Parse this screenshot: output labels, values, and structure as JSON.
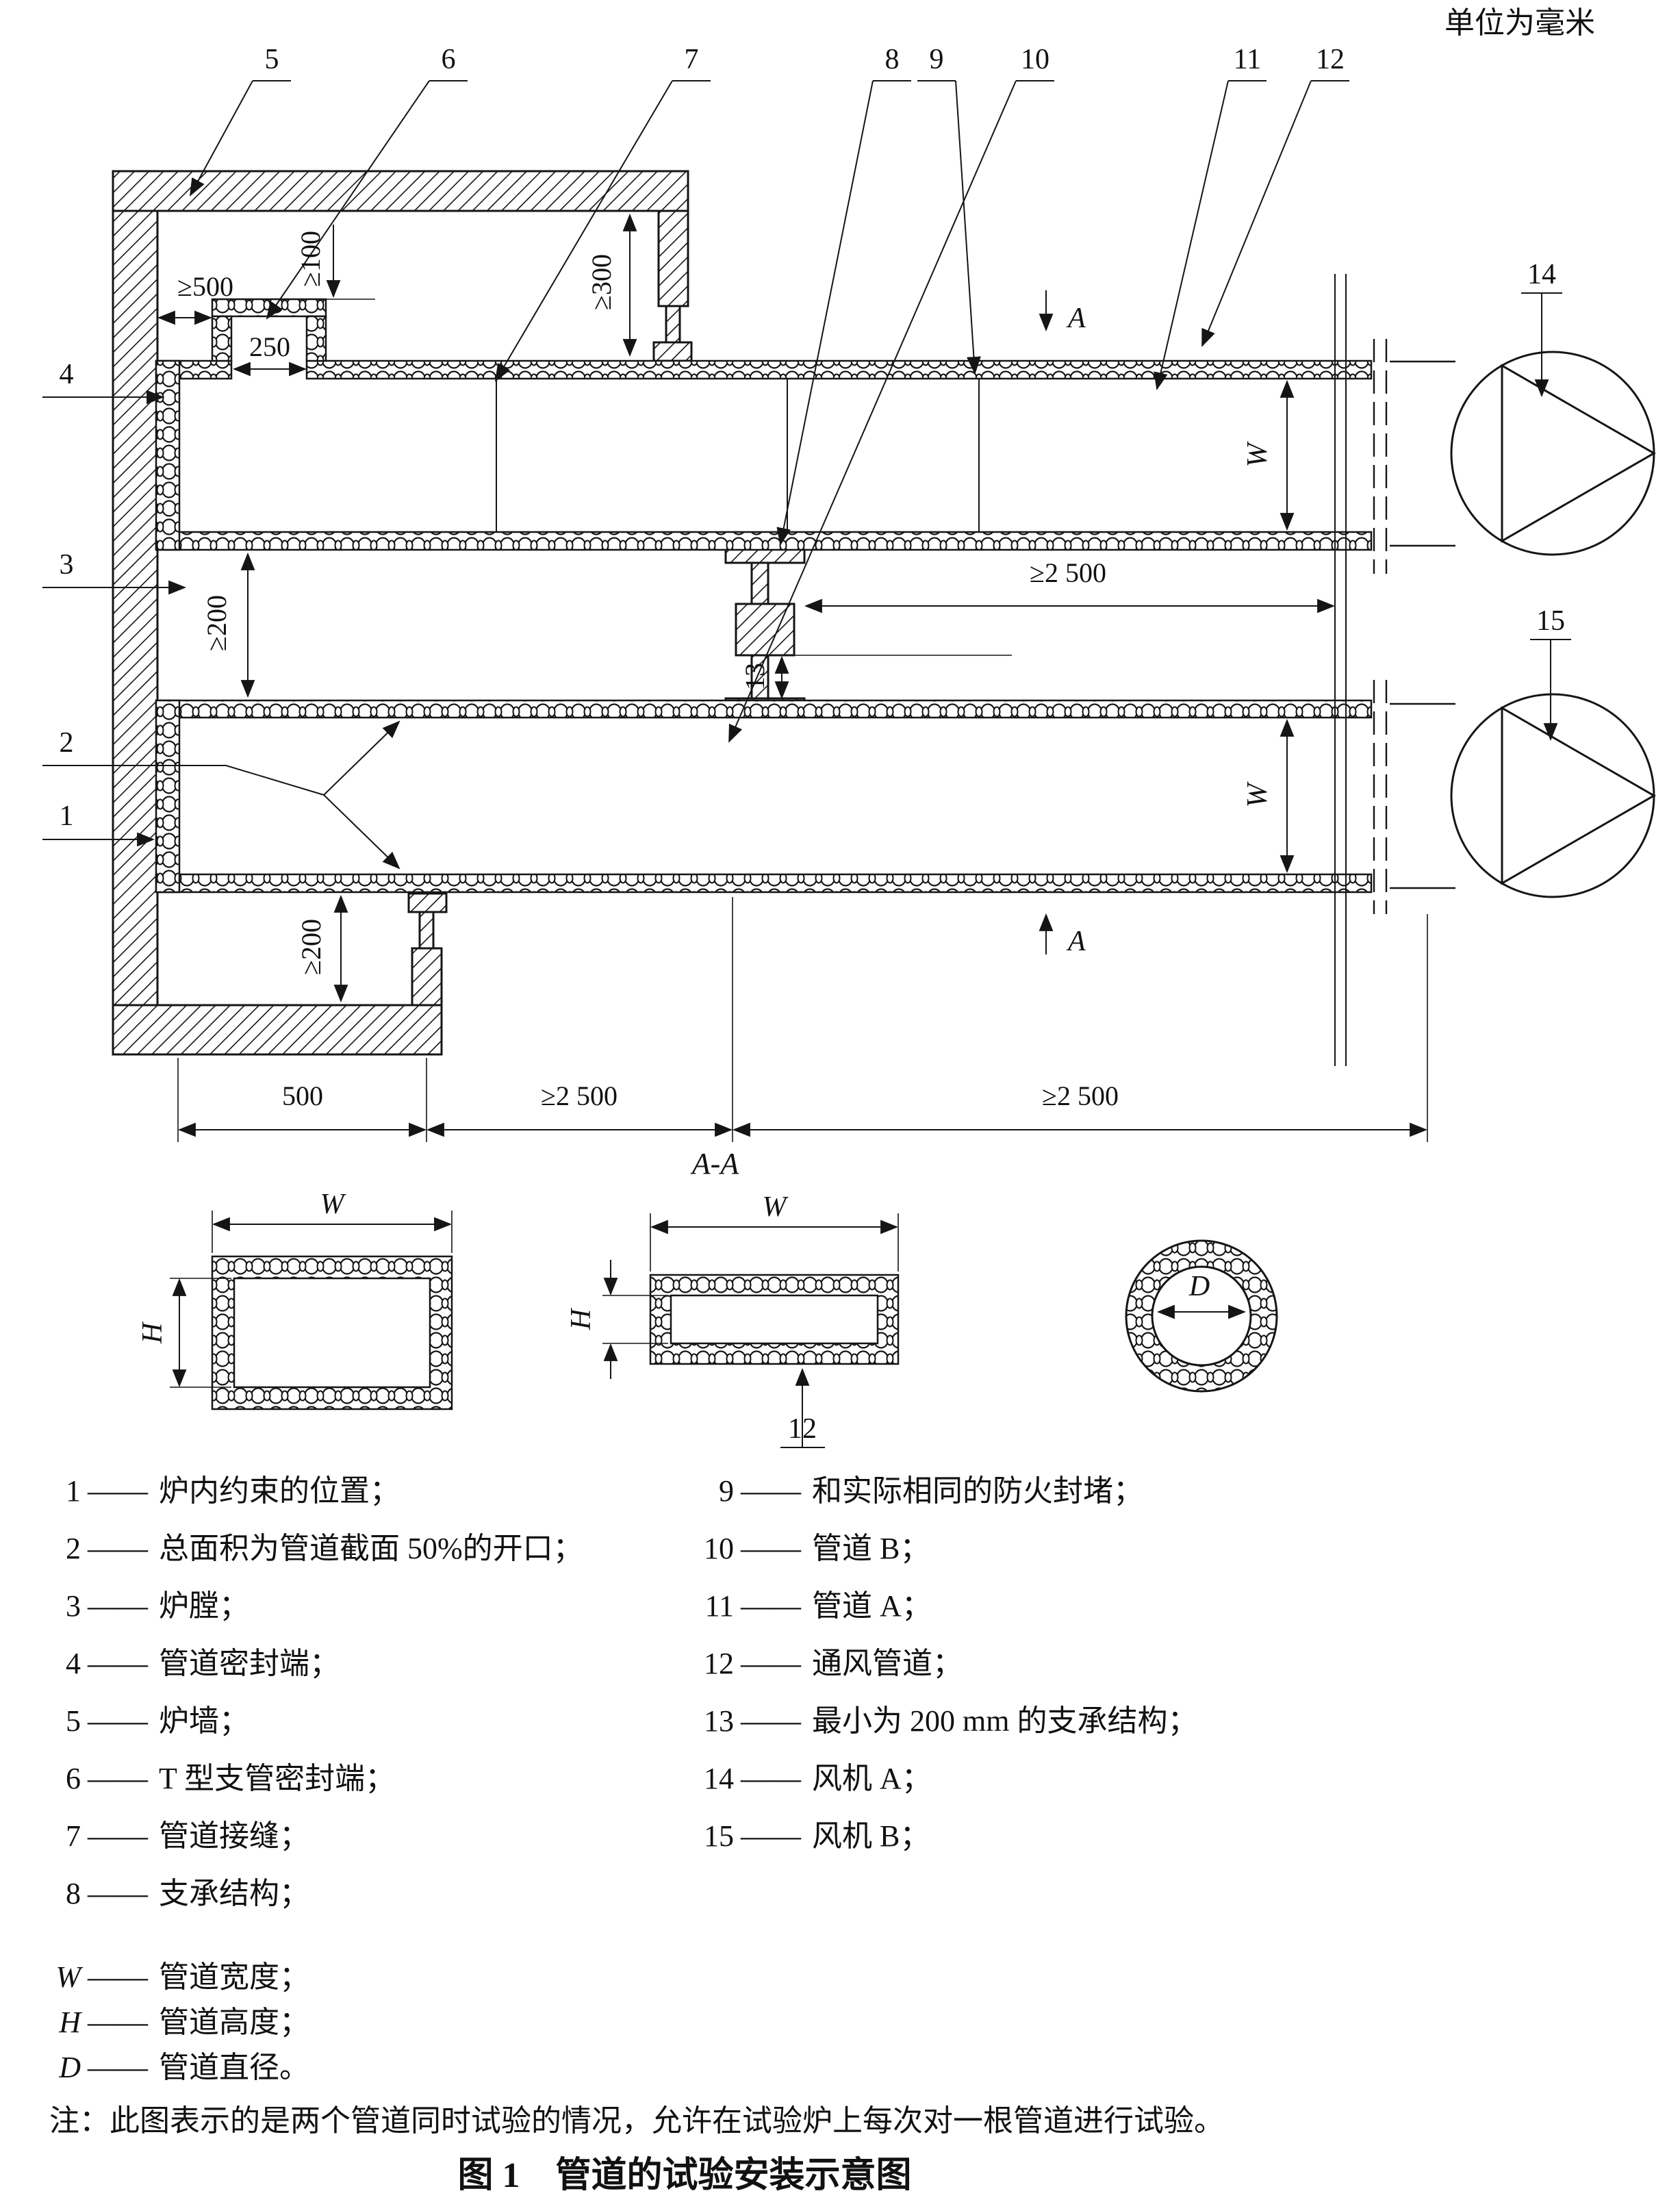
{
  "unit_label": "单位为毫米",
  "callouts": {
    "c1": "1",
    "c2": "2",
    "c3": "3",
    "c4": "4",
    "c5": "5",
    "c6": "6",
    "c7": "7",
    "c8": "8",
    "c9": "9",
    "c10": "10",
    "c11": "11",
    "c12": "12",
    "c13": "13",
    "c14": "14",
    "c15": "15"
  },
  "dims": {
    "ge500": "≥500",
    "d250": "250",
    "ge100": "≥100",
    "ge300": "≥300",
    "ge200": "≥200",
    "ge2500": "≥2 500",
    "d500": "500",
    "d13": "13"
  },
  "letters": {
    "w": "W",
    "h": "H",
    "d": "D",
    "a": "A",
    "aa": "A-A"
  },
  "legend": {
    "separator": "——",
    "items_left": [
      {
        "num": "1",
        "label": "炉内约束的位置；"
      },
      {
        "num": "2",
        "label": "总面积为管道截面 50%的开口；"
      },
      {
        "num": "3",
        "label": "炉膛；"
      },
      {
        "num": "4",
        "label": "管道密封端；"
      },
      {
        "num": "5",
        "label": "炉墙；"
      },
      {
        "num": "6",
        "label": "T 型支管密封端；"
      },
      {
        "num": "7",
        "label": "管道接缝；"
      },
      {
        "num": "8",
        "label": "支承结构；"
      }
    ],
    "items_right": [
      {
        "num": "9",
        "label": "和实际相同的防火封堵；"
      },
      {
        "num": "10",
        "label": "管道 B；"
      },
      {
        "num": "11",
        "label": "管道 A；"
      },
      {
        "num": "12",
        "label": "通风管道；"
      },
      {
        "num": "13",
        "label": "最小为 200 mm 的支承结构；"
      },
      {
        "num": "14",
        "label": "风机 A；"
      },
      {
        "num": "15",
        "label": "风机 B；"
      }
    ],
    "symbols": [
      {
        "sym": "W",
        "label": "管道宽度；"
      },
      {
        "sym": "H",
        "label": "管道高度；"
      },
      {
        "sym": "D",
        "label": "管道直径。"
      }
    ]
  },
  "note": "注：此图表示的是两个管道同时试验的情况，允许在试验炉上每次对一根管道进行试验。",
  "caption": "图 1　管道的试验安装示意图"
}
